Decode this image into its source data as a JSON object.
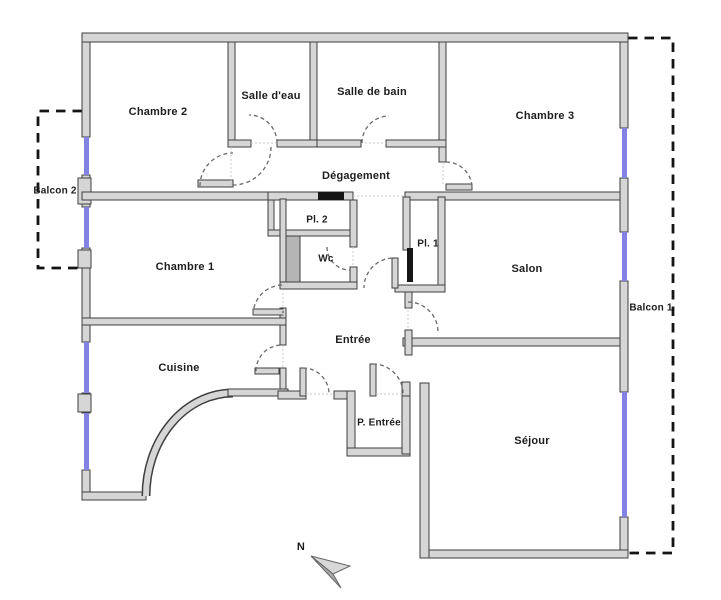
{
  "rooms": {
    "chambre2": {
      "label": "Chambre 2"
    },
    "salle_deau": {
      "label": "Salle d'eau"
    },
    "salle_de_bain": {
      "label": "Salle de bain"
    },
    "chambre3": {
      "label": "Chambre 3"
    },
    "degagement": {
      "label": "Dégagement"
    },
    "balcon2": {
      "label": "Balcon 2"
    },
    "pl2": {
      "label": "Pl. 2"
    },
    "pl1": {
      "label": "Pl. 1"
    },
    "chambre1": {
      "label": "Chambre 1"
    },
    "wc": {
      "label": "Wc"
    },
    "salon": {
      "label": "Salon"
    },
    "entree": {
      "label": "Entrée"
    },
    "cuisine": {
      "label": "Cuisine"
    },
    "p_entree": {
      "label": "P. Entrée"
    },
    "sejour": {
      "label": "Séjour"
    },
    "balcon1": {
      "label": "Balcon 1"
    }
  },
  "compass": {
    "north_label": "N"
  },
  "colors": {
    "wall_fill": "#d6d6d6",
    "wall_line": "#3f3f3f",
    "window_color": "#8282e2",
    "balcony_dash": "#141414",
    "door_arc": "#6a6a6a",
    "shaft_fill": "#b5b5b5",
    "leaf_black": "#151515"
  }
}
